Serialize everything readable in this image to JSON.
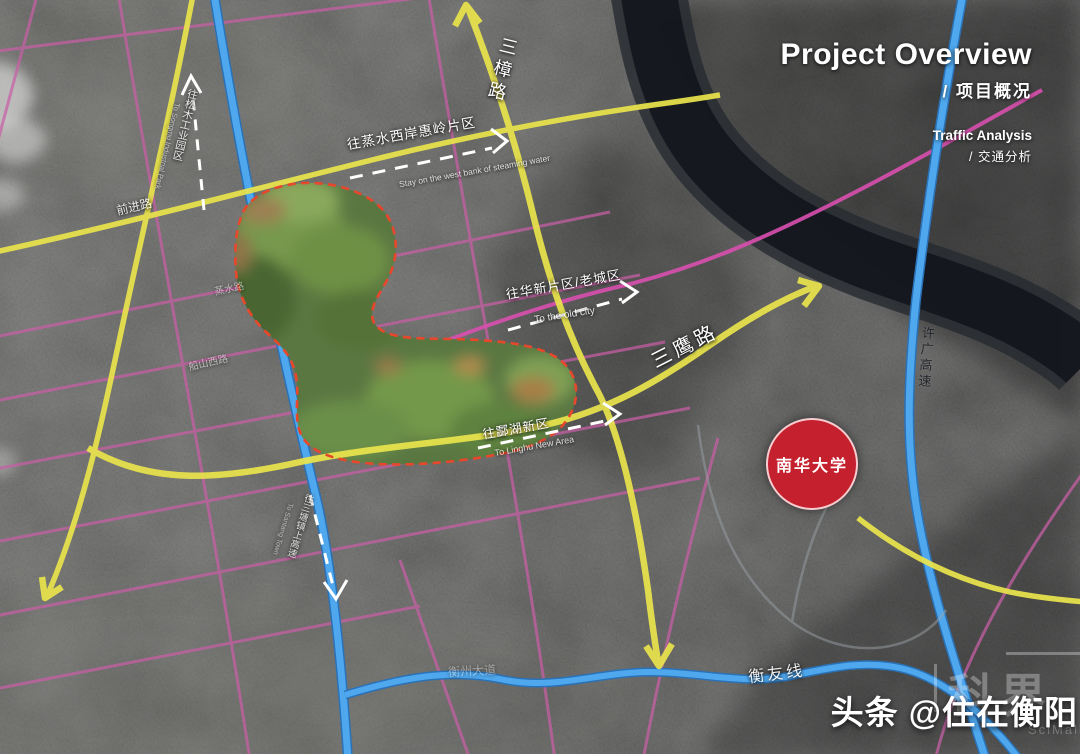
{
  "header": {
    "title_en": "Project Overview",
    "title_zh": "/ 项目概况",
    "subtitle_en": "Traffic Analysis",
    "subtitle_zh": "/ 交通分析"
  },
  "badge": {
    "label": "南华大学"
  },
  "roads": {
    "labels": [
      {
        "id": "sanzhang-road",
        "text": "三樟路"
      },
      {
        "id": "sanying-road",
        "text": "三鹰路"
      },
      {
        "id": "qianjin-road",
        "text": "前进路"
      },
      {
        "id": "xuguang-expwy",
        "text": "许广高速"
      },
      {
        "id": "hengyou-line",
        "text": "衡友线"
      },
      {
        "id": "hengzhou-ave",
        "text": "衡州大道"
      },
      {
        "id": "zhengshui-road",
        "text": "蒸水路"
      },
      {
        "id": "chuanshan-west",
        "text": "船山西路"
      }
    ],
    "colors": {
      "arterial_yellow": "#e9e44c",
      "expressway_blue": "#4fa8ee",
      "planned_pink": "#c95fa6",
      "site_boundary_red": "#e8472b",
      "badge_red": "#c5202e",
      "river_dark": "#14181d"
    }
  },
  "annotations": [
    {
      "id": "to-huiling",
      "zh": "往蒸水西岸惠岭片区",
      "en": "Stay on the west bank of steaming water"
    },
    {
      "id": "to-old-city",
      "zh": "往华新片区/老城区",
      "en": "To the old city"
    },
    {
      "id": "to-linghu",
      "zh": "往酃湖新区",
      "en": "To Linghu New Area"
    },
    {
      "id": "to-industrial",
      "zh": "往松木工业园区",
      "en": "To Songmu Industrial Park"
    },
    {
      "id": "to-santang",
      "zh": "往三塘镇上高速",
      "en": "To Santang Town"
    }
  ],
  "watermarks": {
    "toutiao": "头条 @住在衡阳",
    "scimall_zh": "科界",
    "scimall_en": "SciMall"
  }
}
